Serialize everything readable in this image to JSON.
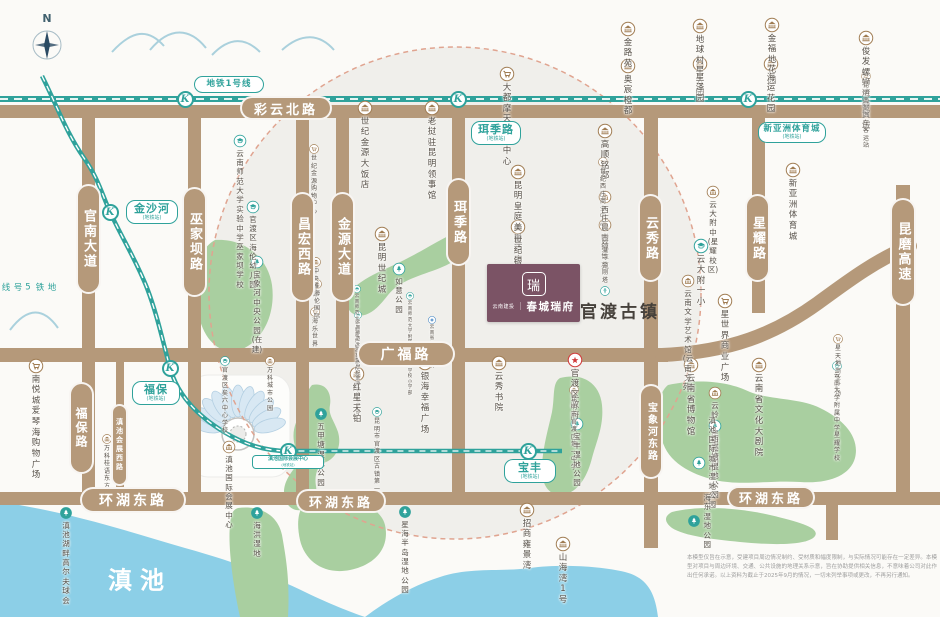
{
  "colors": {
    "road": "#b5997a",
    "metro": "#2fa29b",
    "park": "#a9cfa0",
    "lake": "#8ccfe7",
    "zone_fill": "#f0efeb",
    "zone_border": "#e0a490",
    "poi_brown": "#a07c52",
    "logo_bg": "#7b5365",
    "gov_red": "#d03a3a",
    "hospital_blue": "#3a7fc1"
  },
  "compass": {
    "label": "N"
  },
  "logo": {
    "brand_small": "云南建投",
    "divider": "｜",
    "brand_main": "春城瑞府",
    "emblem": "瑞"
  },
  "area_labels": {
    "ancient_town": "官渡古镇",
    "lake": "滇池",
    "metro_line5": "地铁5号线"
  },
  "metro": {
    "line1_label": "地铁1号线",
    "station_letter": "K",
    "line1_y": 99,
    "line1_stations_x": [
      185,
      458,
      748
    ],
    "line5_path": "M 42,76 C 58,108 66,132 84,158 C 98,178 102,194 110,212 C 122,238 136,260 147,288 C 157,314 163,342 170,368 C 178,396 198,416 224,432 C 244,444 264,451 288,451 L 528,451 L 562,451",
    "line5_stations": [
      [
        110,
        212
      ],
      [
        170,
        368
      ],
      [
        288,
        451
      ],
      [
        528,
        451
      ]
    ],
    "callouts": [
      {
        "text": "金沙河",
        "sub": "(地铁站)",
        "x": 126,
        "y": 200,
        "w": 52
      },
      {
        "text": "珥季路",
        "sub": "(地铁站)",
        "x": 471,
        "y": 121,
        "w": 50
      },
      {
        "text": "新亚洲体育城",
        "sub": "(地铁站)",
        "x": 758,
        "y": 122,
        "w": 68,
        "small": true
      },
      {
        "text": "福保",
        "sub": "(地铁站)",
        "x": 132,
        "y": 381,
        "w": 48
      },
      {
        "text": "宝丰",
        "sub": "(地铁站)",
        "x": 504,
        "y": 459,
        "w": 52
      },
      {
        "text": "滇池国际会展中心",
        "sub": "(地铁站)",
        "x": 252,
        "y": 455,
        "w": 72,
        "tiny": true
      }
    ]
  },
  "roads": {
    "bars": [
      {
        "x": 0,
        "y": 105,
        "w": 940,
        "h": 13
      },
      {
        "x": 0,
        "y": 348,
        "w": 668,
        "h": 14
      },
      {
        "x": 0,
        "y": 492,
        "w": 940,
        "h": 13
      },
      {
        "x": 82,
        "y": 112,
        "w": 13,
        "h": 388
      },
      {
        "x": 188,
        "y": 112,
        "w": 13,
        "h": 388
      },
      {
        "x": 296,
        "y": 112,
        "w": 13,
        "h": 388
      },
      {
        "x": 336,
        "y": 112,
        "w": 13,
        "h": 243
      },
      {
        "x": 452,
        "y": 112,
        "w": 13,
        "h": 388
      },
      {
        "x": 116,
        "y": 355,
        "w": 8,
        "h": 140
      },
      {
        "x": 644,
        "y": 108,
        "w": 14,
        "h": 440
      },
      {
        "x": 752,
        "y": 108,
        "w": 13,
        "h": 205
      },
      {
        "x": 896,
        "y": 185,
        "w": 14,
        "h": 313
      },
      {
        "x": 826,
        "y": 492,
        "w": 12,
        "h": 48
      }
    ],
    "curve_path": "M 662,355 C 730,352 775,334 818,303 C 848,281 876,260 910,246",
    "labels": [
      {
        "text": "彩云北路",
        "x": 240,
        "y": 96,
        "w": 92,
        "h": 24,
        "fs": 13
      },
      {
        "text": "广福路",
        "x": 357,
        "y": 341,
        "w": 98,
        "h": 26,
        "fs": 14
      },
      {
        "text": "环湖东路",
        "x": 80,
        "y": 487,
        "w": 106,
        "h": 26,
        "fs": 14
      },
      {
        "text": "环湖东路",
        "x": 296,
        "y": 489,
        "w": 90,
        "h": 24,
        "fs": 13
      },
      {
        "text": "环湖东路",
        "x": 727,
        "y": 486,
        "w": 88,
        "h": 23,
        "fs": 13
      },
      {
        "text": "官南大道",
        "x": 76,
        "y": 184,
        "w": 25,
        "h": 110,
        "fs": 13,
        "vert": true
      },
      {
        "text": "巫家坝路",
        "x": 182,
        "y": 187,
        "w": 25,
        "h": 110,
        "fs": 13,
        "vert": true
      },
      {
        "text": "昌宏西路",
        "x": 290,
        "y": 192,
        "w": 25,
        "h": 110,
        "fs": 13,
        "vert": true
      },
      {
        "text": "金源大道",
        "x": 330,
        "y": 192,
        "w": 25,
        "h": 110,
        "fs": 13,
        "vert": true
      },
      {
        "text": "珥季路",
        "x": 446,
        "y": 178,
        "w": 25,
        "h": 88,
        "fs": 13,
        "vert": true
      },
      {
        "text": "云秀路",
        "x": 638,
        "y": 194,
        "w": 25,
        "h": 88,
        "fs": 13,
        "vert": true
      },
      {
        "text": "星耀路",
        "x": 745,
        "y": 194,
        "w": 25,
        "h": 88,
        "fs": 13,
        "vert": true
      },
      {
        "text": "昆磨高速",
        "x": 890,
        "y": 198,
        "w": 26,
        "h": 108,
        "fs": 13,
        "vert": true
      },
      {
        "text": "福保路",
        "x": 69,
        "y": 382,
        "w": 25,
        "h": 92,
        "fs": 12,
        "vert": true
      },
      {
        "text": "宝象河东路",
        "x": 639,
        "y": 384,
        "w": 24,
        "h": 95,
        "fs": 10,
        "vert": true
      },
      {
        "text": "滇池会展西路",
        "x": 111,
        "y": 404,
        "w": 17,
        "h": 82,
        "fs": 7,
        "vert": true
      }
    ]
  },
  "pois": [
    {
      "t": "金路苑",
      "i": "building",
      "x": 628,
      "y": 29
    },
    {
      "t": "奥宸橙都",
      "i": "building",
      "x": 628,
      "y": 66
    },
    {
      "t": "地球村星云园",
      "i": "building",
      "x": 700,
      "y": 26
    },
    {
      "t": "星泽园",
      "i": "building",
      "x": 700,
      "y": 64
    },
    {
      "t": "金福地花园",
      "i": "building",
      "x": 772,
      "y": 25
    },
    {
      "t": "海运花园",
      "i": "building",
      "x": 771,
      "y": 64
    },
    {
      "t": "俊发螺蛳湾\n商贸城",
      "i": "building",
      "x": 866,
      "y": 38
    },
    {
      "t": "昆明南部汽车客运站",
      "i": "bus",
      "x": 866,
      "y": 76,
      "s": "micro"
    },
    {
      "t": "大都摩天购物中心",
      "i": "shop",
      "x": 507,
      "y": 74
    },
    {
      "t": "云南师范大学实验中学\n巫家坝学校",
      "i": "school",
      "x": 240,
      "y": 141,
      "s": "small"
    },
    {
      "t": "官渡区\n海伦幼儿园",
      "i": "school",
      "x": 253,
      "y": 207,
      "s": "small"
    },
    {
      "t": "世纪金源大饭店",
      "i": "building",
      "x": 365,
      "y": 108
    },
    {
      "t": "老挝驻昆明领事馆",
      "i": "building",
      "x": 432,
      "y": 108
    },
    {
      "t": "世纪金源\n购物中心",
      "i": "shop",
      "x": 314,
      "y": 149,
      "s": "micro"
    },
    {
      "t": "昆明世纪城",
      "i": "building",
      "x": 382,
      "y": 234
    },
    {
      "t": "高顺铭都",
      "i": "building",
      "x": 605,
      "y": 131
    },
    {
      "t": "世纪西庄\n商业中心",
      "i": "shop",
      "x": 603,
      "y": 162,
      "s": "micro"
    },
    {
      "t": "西庄晨曦园",
      "i": "building",
      "x": 605,
      "y": 197,
      "s": "small"
    },
    {
      "t": "古镇佳苑",
      "i": "building",
      "x": 605,
      "y": 225,
      "s": "small"
    },
    {
      "t": "昆明皇庭美爵酒店",
      "i": "building",
      "x": 518,
      "y": 172
    },
    {
      "t": "世纪银都",
      "i": "building",
      "x": 518,
      "y": 227
    },
    {
      "t": "云大附中\n(星耀校区)",
      "i": "building",
      "x": 713,
      "y": 192,
      "s": "small"
    },
    {
      "t": "云大附一小",
      "i": "school",
      "x": 701,
      "y": 246
    },
    {
      "t": "新亚洲\n体育城",
      "i": "building",
      "x": 793,
      "y": 170
    },
    {
      "t": "妙湛寺金刚塔",
      "i": "pagoda",
      "x": 605,
      "y": 291,
      "above": true,
      "s": "micro"
    },
    {
      "t": "云南文学艺术馆\n(云南文苑)",
      "i": "building",
      "x": 688,
      "y": 281,
      "s": "small"
    },
    {
      "t": "星世界\n商业广场",
      "i": "shop",
      "x": 725,
      "y": 301
    },
    {
      "t": "星天地商业广场",
      "i": "shop",
      "x": 838,
      "y": 339,
      "s": "micro"
    },
    {
      "t": "云南大学附属中学\n星耀学校",
      "i": "school",
      "x": 837,
      "y": 366,
      "s": "micro"
    },
    {
      "t": "宝象河\n中央公园\n(在建)",
      "i": "tree",
      "x": 257,
      "y": 262,
      "s": "small"
    },
    {
      "t": "如意公园",
      "i": "tree",
      "x": 399,
      "y": 269,
      "s": "small"
    },
    {
      "t": "中央雅邸",
      "i": "building",
      "x": 316,
      "y": 262,
      "s": "micro"
    },
    {
      "t": "海伦国际",
      "i": "building",
      "x": 317,
      "y": 284,
      "s": "micro"
    },
    {
      "t": "海乐世界",
      "i": "shop",
      "x": 315,
      "y": 312,
      "s": "micro"
    },
    {
      "t": "云南师范大学附属\n世纪金源学校幼儿园",
      "i": "school",
      "x": 357,
      "y": 289,
      "s": "nano"
    },
    {
      "t": "云南师范大学附属\n世纪金源学校小学部",
      "i": "school",
      "x": 410,
      "y": 296,
      "s": "nano"
    },
    {
      "t": "云南师范大学附属\n世纪金源学校中学部",
      "i": "school",
      "x": 358,
      "y": 315,
      "s": "nano"
    },
    {
      "t": "云南省妇幼保健院",
      "i": "hospital",
      "x": 432,
      "y": 320,
      "s": "nano"
    },
    {
      "t": "南悦城爱琴海\n购物广场",
      "i": "shop",
      "x": 36,
      "y": 366
    },
    {
      "t": "万科\n桂语东方",
      "i": "building",
      "x": 107,
      "y": 439,
      "s": "micro"
    },
    {
      "t": "官渡区矣六中心学校",
      "i": "school",
      "x": 225,
      "y": 361,
      "s": "micro"
    },
    {
      "t": "万科城市公园",
      "i": "building",
      "x": 270,
      "y": 361,
      "s": "micro"
    },
    {
      "t": "滇池国际会展中心",
      "i": "building",
      "x": 229,
      "y": 447,
      "s": "small"
    },
    {
      "t": "红星天铂",
      "i": "building",
      "x": 357,
      "y": 374
    },
    {
      "t": "五甲塘\n湿地公园",
      "i": "tree2",
      "x": 321,
      "y": 414,
      "s": "small"
    },
    {
      "t": "昆明市官渡区\n古镇第一小学",
      "i": "school",
      "x": 377,
      "y": 412,
      "s": "micro"
    },
    {
      "t": "银海幸福广场",
      "i": "building",
      "x": 425,
      "y": 363
    },
    {
      "t": "云秀书院",
      "i": "building",
      "x": 499,
      "y": 363
    },
    {
      "t": "官渡区政府",
      "i": "star",
      "x": 575,
      "y": 360
    },
    {
      "t": "昆明市官渡区\n第一中学",
      "i": "building",
      "x": 574,
      "y": 390,
      "s": "micro"
    },
    {
      "t": "宝丰\n湿地公园",
      "i": "tree",
      "x": 577,
      "y": 424,
      "s": "small"
    },
    {
      "t": "云岭·星河庄园",
      "i": "building",
      "x": 715,
      "y": 393,
      "s": "small"
    },
    {
      "t": "西亮塘湿地公园",
      "i": "tree",
      "x": 715,
      "y": 426,
      "s": "small"
    },
    {
      "t": "滇池国际\n城市湿地公园",
      "i": "tree",
      "x": 699,
      "y": 463,
      "side": "right",
      "s": "small"
    },
    {
      "t": "云南省博物馆",
      "i": "building",
      "x": 691,
      "y": 365
    },
    {
      "t": "云南省文化大剧院",
      "i": "building",
      "x": 759,
      "y": 365
    },
    {
      "t": "星海半岛\n湿地公园",
      "i": "tree2",
      "x": 405,
      "y": 512,
      "s": "small"
    },
    {
      "t": "招商雍景湾",
      "i": "building",
      "x": 527,
      "y": 510
    },
    {
      "t": "山海湾1号",
      "i": "building",
      "x": 563,
      "y": 544
    },
    {
      "t": "滇池湖畔高尔夫球会",
      "i": "tree2",
      "x": 66,
      "y": 513,
      "s": "small"
    },
    {
      "t": "海洪湿地",
      "i": "tree2",
      "x": 257,
      "y": 513,
      "s": "small"
    },
    {
      "t": "海东湿地公园",
      "i": "tree2",
      "x": 694,
      "y": 521,
      "side": "right",
      "s": "small"
    }
  ],
  "disclaimer": "本模型仅旨在示意，受建项目周边情况制约、受材质和幅度限制，与实际情况可能存在一定差异。本模型对项目与周边环境、交通、公共设施的地理关系示意，旨在协助提供相关信息，不意味着公司对此作出任何承诺。以上资料为截止于2025年9月的情况，一切未列举事项或更改，不再另行通知。"
}
